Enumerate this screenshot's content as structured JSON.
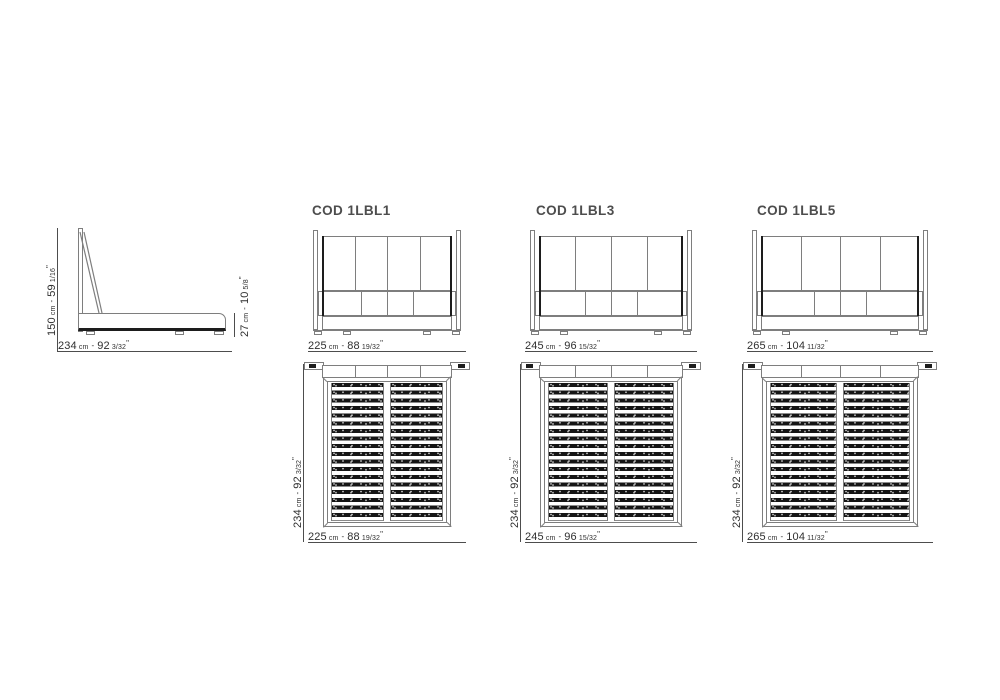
{
  "units": {
    "cm_label": "cm",
    "separator": "-",
    "inch_mark": "\""
  },
  "side_view": {
    "height": {
      "cm": "150",
      "in": "59",
      "frac": "1/16"
    },
    "width": {
      "cm": "234",
      "in": "92",
      "frac": "3/32"
    },
    "base_height": {
      "cm": "27",
      "in": "10",
      "frac": "5/8"
    }
  },
  "models": [
    {
      "code": "COD 1LBL1",
      "width": {
        "cm": "225",
        "in": "88",
        "frac": "19/32"
      },
      "depth": {
        "cm": "234",
        "in": "92",
        "frac": "3/32"
      }
    },
    {
      "code": "COD 1LBL3",
      "width": {
        "cm": "245",
        "in": "96",
        "frac": "15/32"
      },
      "depth": {
        "cm": "234",
        "in": "92",
        "frac": "3/32"
      }
    },
    {
      "code": "COD 1LBL5",
      "width": {
        "cm": "265",
        "in": "104",
        "frac": "11/32"
      },
      "depth": {
        "cm": "234",
        "in": "92",
        "frac": "3/32"
      }
    }
  ],
  "colors": {
    "background": "#ffffff",
    "line": "#7e7e7e",
    "dark_line": "#1d1d1d",
    "dim_line": "#4d4d4d",
    "text": "#2f2f2f",
    "title_text": "#4d4d4d",
    "slat_fill": "#151515"
  }
}
